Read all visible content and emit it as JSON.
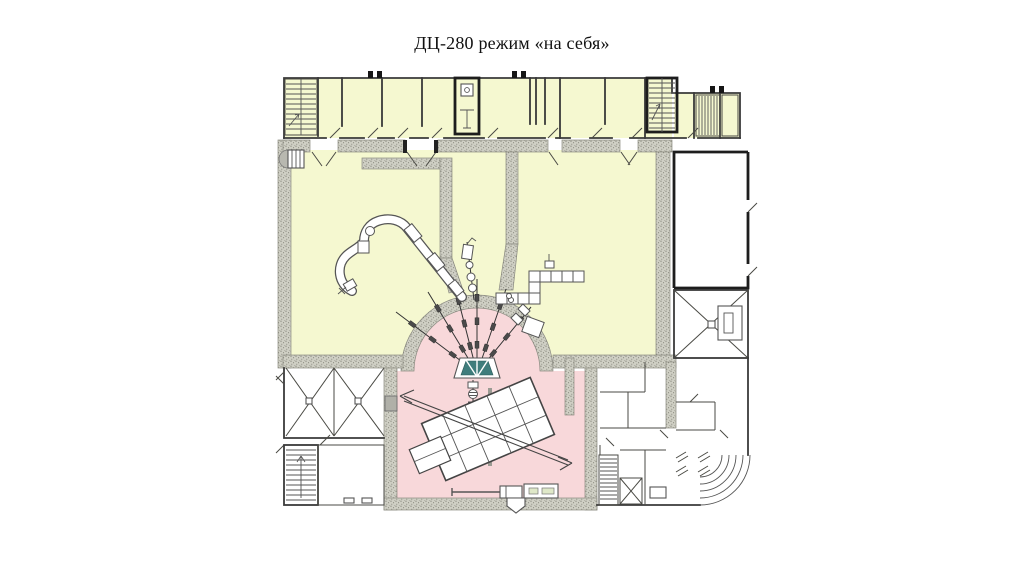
{
  "title": "ДЦ-280 режим «на себя»",
  "colors": {
    "room_yellow": "#f5f8d0",
    "room_pink": "#f8d8da",
    "wall_base": "#cfcfc4",
    "wall_dot": "#6f6f64",
    "magnet_teal": "#3f7d7c",
    "line_dark": "#3a3a3a",
    "page_bg": "#ffffff"
  }
}
